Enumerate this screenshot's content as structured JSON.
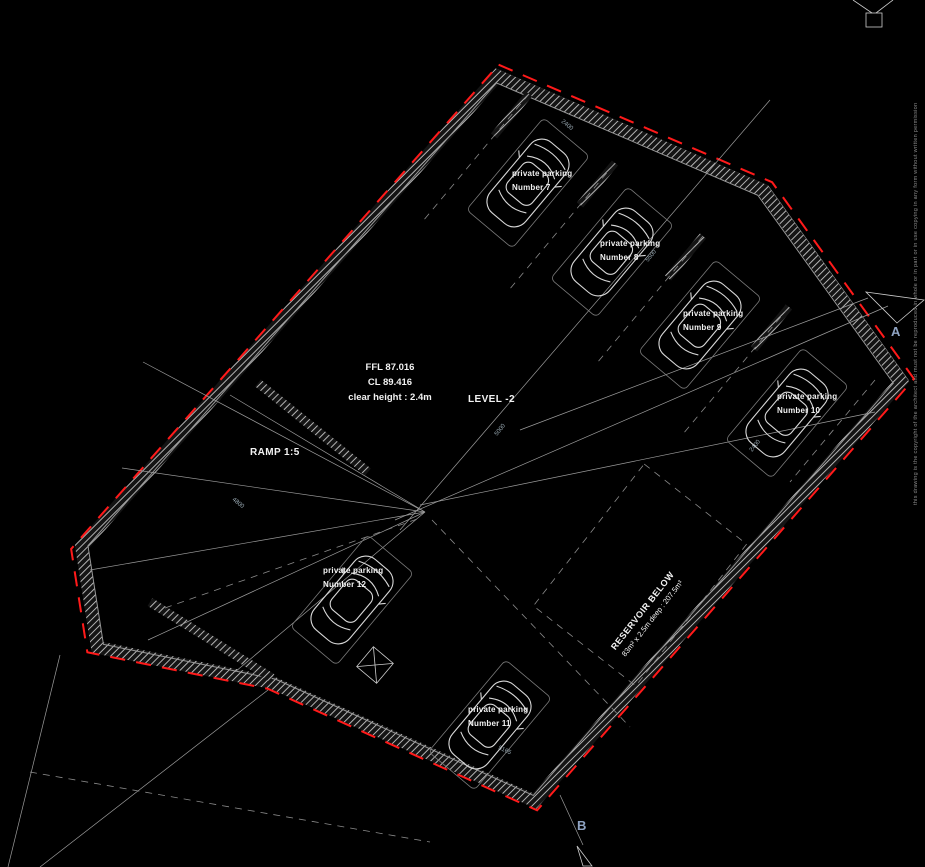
{
  "plan": {
    "level_label": "LEVEL -2",
    "ramp_label": "RAMP 1:5",
    "levels_block": {
      "line1": "FFL 87.016",
      "line2": "CL 89.416",
      "line3": "clear height : 2.4m"
    },
    "reservoir": {
      "line1": "RESERVOIR BELOW",
      "line2": "83m² x 2.5m deep : 207.5m³"
    },
    "parking_spaces": [
      {
        "line1": "private parking",
        "line2": "Number 7"
      },
      {
        "line1": "private parking",
        "line2": "Number 8"
      },
      {
        "line1": "private parking",
        "line2": "Number 9"
      },
      {
        "line1": "private parking",
        "line2": "Number 10"
      },
      {
        "line1": "private parking",
        "line2": "Number 11"
      },
      {
        "line1": "private parking",
        "line2": "Number 12"
      }
    ],
    "section_markers": {
      "a": "A",
      "b": "B"
    },
    "dimensions": [
      "2400",
      "5500",
      "5000",
      "4800",
      "5165",
      "2400"
    ],
    "copyright_notice": "this drawing is the copyright of the architect and must not be reproduced in whole or in part or in use copying in any form without written permission",
    "colors": {
      "background": "#000000",
      "boundary": "#ff1a1a",
      "wall_hatch": "#b5b5b5",
      "car_outline": "#d8d8d8",
      "label_text": "#f2f2f2",
      "dim_text": "#9fb0ba",
      "marker_text": "#8fa3c2",
      "line": "#9c9c9c"
    }
  }
}
